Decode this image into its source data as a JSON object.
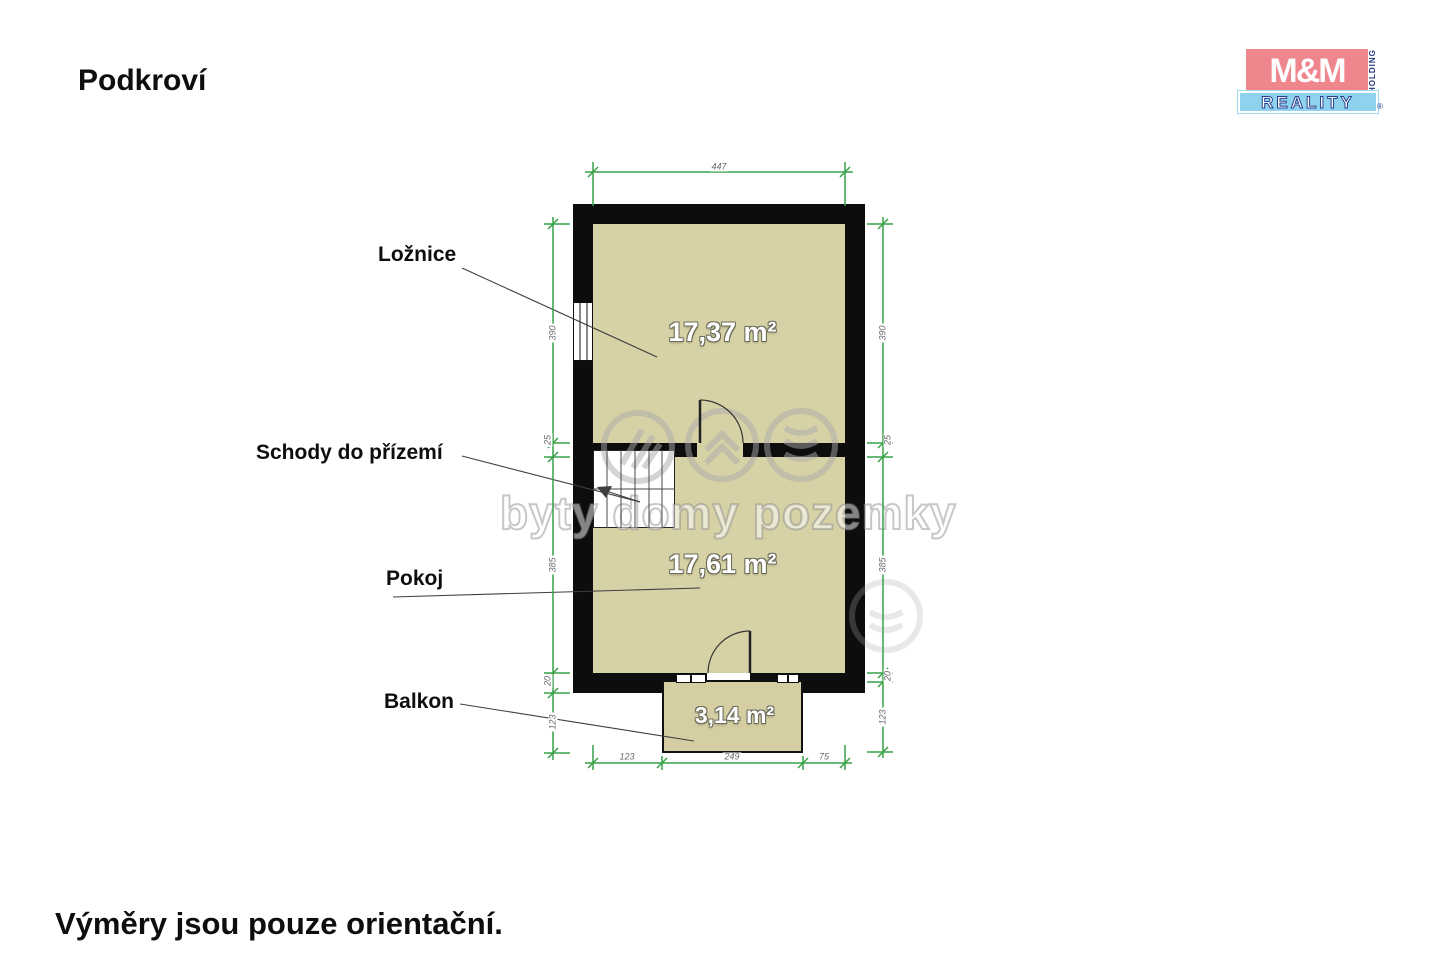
{
  "title": "Podkroví",
  "footer_note": "Výměry jsou pouze orientační.",
  "logo": {
    "mm": "M&M",
    "holding": "HOLDING",
    "reality": "REALITY",
    "registered": "®"
  },
  "watermark_text": "byty domy pozemky",
  "floorplan": {
    "rooms": [
      {
        "label": "Ložnice",
        "area": "17,37 m²"
      },
      {
        "label": "Schody do přízemí",
        "area": ""
      },
      {
        "label": "Pokoj",
        "area": "17,61 m²"
      },
      {
        "label": "Balkon",
        "area": "3,14 m²"
      }
    ],
    "dimensions": {
      "top": "447",
      "left": [
        "390",
        "25",
        "385",
        "20",
        "123"
      ],
      "right": [
        "390",
        "25",
        "385",
        "20",
        "123"
      ],
      "bottom": [
        "123",
        "249",
        "75"
      ]
    }
  },
  "colors": {
    "wall": "#0d0d0d",
    "floor": "#d7d1a6",
    "dimension_green": "#38a148",
    "logo_pink": "#ef858d",
    "logo_blue": "#8fd2ee",
    "watermark_gray": "#aaaaaa"
  }
}
